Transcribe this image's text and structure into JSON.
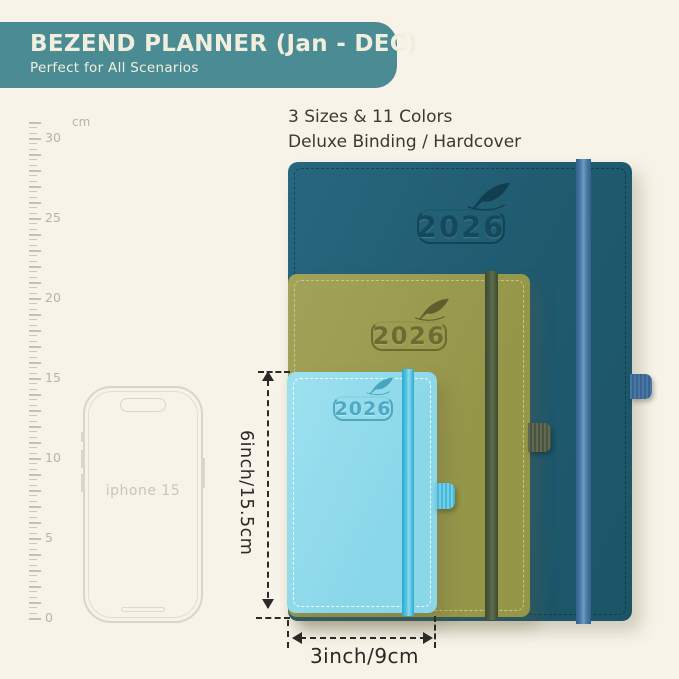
{
  "background_color": "#f7f3e8",
  "banner": {
    "title": "BEZEND PLANNER (Jan - DEC)",
    "subtitle": "Perfect for All Scenarios",
    "bg_color": "#4b8c94",
    "text_color": "#f2eedd"
  },
  "headline": {
    "line1": "3 Sizes & 11 Colors",
    "line2": "Deluxe Binding / Hardcover"
  },
  "ruler": {
    "unit": "cm",
    "max_cm": 31,
    "label_step_cm": 5,
    "px_per_cm": 16,
    "bottom_y": 618
  },
  "phone": {
    "label": "iphone 15"
  },
  "planners": [
    {
      "id": "large-planner",
      "year": "2026",
      "cover_color": "#205c70",
      "band_color": "#4c7ba7",
      "logo_icon": "feather-icon"
    },
    {
      "id": "medium-planner",
      "year": "2026",
      "cover_color": "#9a9a52",
      "band_color": "#4e5c40",
      "logo_icon": "feather-icon"
    },
    {
      "id": "small-planner",
      "year": "2026",
      "cover_color": "#90dcec",
      "band_color": "#4fc2e2",
      "logo_icon": "feather-icon"
    }
  ],
  "dimensions": {
    "height_label": "6inch/15.5cm",
    "width_label": "3inch/9cm"
  }
}
